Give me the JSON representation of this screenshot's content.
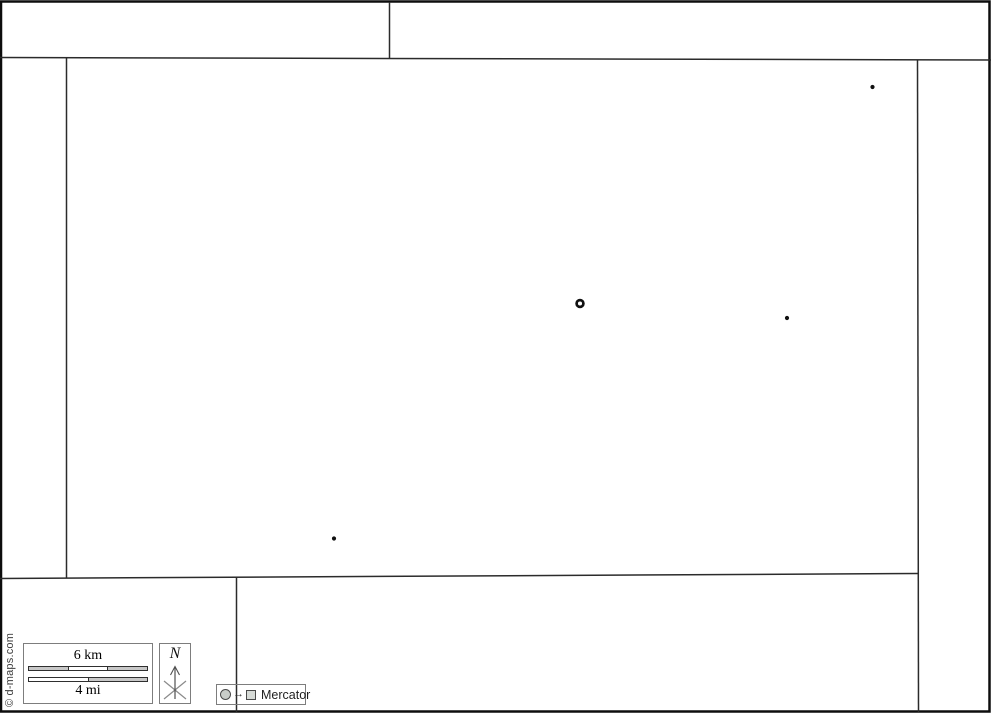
{
  "canvas": {
    "width": 991,
    "height": 713,
    "background": "#ffffff"
  },
  "colors": {
    "frame": "#0d0d0d",
    "boundary": "#2b2b2b",
    "marker": "#111111",
    "box_border": "#7d7d7d",
    "bar_gray": "#c8c8c8",
    "bar_white": "#ffffff"
  },
  "map": {
    "frame": {
      "x": 1,
      "y": 1.5,
      "width": 988.5,
      "height": 710,
      "stroke_width": 2.5
    },
    "boundaries": [
      {
        "name": "north-boundary-line",
        "points": [
          [
            0,
            57.5
          ],
          [
            991,
            60
          ]
        ]
      },
      {
        "name": "top-strip-divider-line",
        "points": [
          [
            389.5,
            2
          ],
          [
            389.5,
            58.5
          ]
        ]
      },
      {
        "name": "west-boundary-line",
        "points": [
          [
            66.5,
            58
          ],
          [
            66.5,
            578.5
          ]
        ]
      },
      {
        "name": "east-boundary-line",
        "points": [
          [
            917.5,
            60
          ],
          [
            918.5,
            712
          ]
        ]
      },
      {
        "name": "south-boundary-line",
        "points": [
          [
            0,
            578.5
          ],
          [
            918.5,
            573.5
          ]
        ]
      },
      {
        "name": "south-strip-divider-line",
        "points": [
          [
            236.5,
            577
          ],
          [
            236.5,
            712
          ]
        ]
      }
    ],
    "markers": {
      "ring": {
        "cx": 580,
        "cy": 303.5,
        "r": 3.4,
        "stroke_width": 2.7
      },
      "dots": [
        {
          "cx": 872.5,
          "cy": 87,
          "r": 2.1
        },
        {
          "cx": 787,
          "cy": 318,
          "r": 2.1
        },
        {
          "cx": 334,
          "cy": 538.5,
          "r": 2.1
        }
      ]
    }
  },
  "scalebar": {
    "km_label": "6 km",
    "mi_label": "4 mi",
    "km_segments": [
      "#c8c8c8",
      "#ffffff",
      "#c8c8c8"
    ],
    "mi_segments": [
      "#ffffff",
      "#c8c8c8"
    ]
  },
  "compass": {
    "label": "N"
  },
  "legend": {
    "arrow_glyph": "→",
    "projection": "Mercator"
  },
  "copyright": {
    "text": "© d-maps.com"
  }
}
